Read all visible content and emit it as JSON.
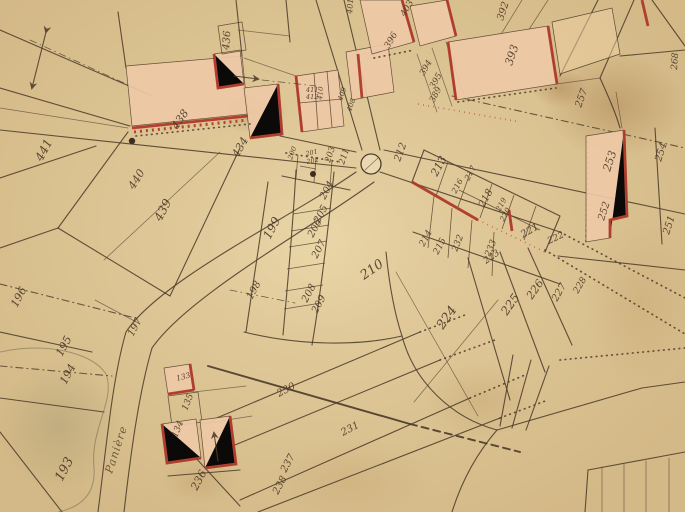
{
  "map": {
    "type": "historical-cadastral-map",
    "description": "Hand-drawn cadastral plan of a village crossroads with numbered parcels and red-edged buildings",
    "colors": {
      "paper": "#e6d0a2",
      "ink": "#4c3c2a",
      "building_fill": "#eec9a7",
      "building_edge": "#ae3a2b"
    },
    "road_label": {
      "text": "Panière",
      "x": 112,
      "y": 474,
      "rot": -72
    },
    "well": {
      "x": 371,
      "y": 164,
      "r": 10
    },
    "parcel_labels": [
      {
        "t": "441",
        "x": 42,
        "y": 162,
        "r": -62,
        "s": 12
      },
      {
        "t": "440",
        "x": 134,
        "y": 190,
        "r": -58,
        "s": 11
      },
      {
        "t": "439",
        "x": 161,
        "y": 222,
        "r": -62,
        "s": 12
      },
      {
        "t": "438",
        "x": 177,
        "y": 130,
        "r": -55,
        "s": 11
      },
      {
        "t": "434",
        "x": 238,
        "y": 158,
        "r": -60,
        "s": 11
      },
      {
        "t": "436",
        "x": 229,
        "y": 50,
        "r": -86,
        "s": 10
      },
      {
        "t": "411",
        "x": 306,
        "y": 92,
        "r": 0,
        "s": 6.5
      },
      {
        "t": "412",
        "x": 306,
        "y": 99,
        "r": 0,
        "s": 6.5
      },
      {
        "t": "410",
        "x": 322,
        "y": 100,
        "r": -85,
        "s": 7
      },
      {
        "t": "409",
        "x": 342,
        "y": 101,
        "r": -70,
        "s": 7
      },
      {
        "t": "408",
        "x": 351,
        "y": 112,
        "r": -70,
        "s": 7
      },
      {
        "t": "401",
        "x": 352,
        "y": 14,
        "r": -85,
        "s": 8
      },
      {
        "t": "403",
        "x": 405,
        "y": 17,
        "r": -60,
        "s": 9
      },
      {
        "t": "396",
        "x": 389,
        "y": 49,
        "r": -60,
        "s": 9
      },
      {
        "t": "394",
        "x": 424,
        "y": 76,
        "r": -60,
        "s": 8.5
      },
      {
        "t": "395",
        "x": 434,
        "y": 89,
        "r": -60,
        "s": 8.5
      },
      {
        "t": "389",
        "x": 434,
        "y": 103,
        "r": -62,
        "s": 8.5
      },
      {
        "t": "392",
        "x": 503,
        "y": 21,
        "r": -72,
        "s": 10
      },
      {
        "t": "393",
        "x": 512,
        "y": 66,
        "r": -72,
        "s": 11
      },
      {
        "t": "257",
        "x": 581,
        "y": 108,
        "r": -70,
        "s": 10
      },
      {
        "t": "268",
        "x": 677,
        "y": 70,
        "r": -86,
        "s": 9
      },
      {
        "t": "254",
        "x": 661,
        "y": 162,
        "r": -72,
        "s": 10
      },
      {
        "t": "253",
        "x": 610,
        "y": 172,
        "r": -72,
        "s": 11
      },
      {
        "t": "252",
        "x": 604,
        "y": 221,
        "r": -72,
        "s": 10
      },
      {
        "t": "251",
        "x": 669,
        "y": 235,
        "r": -72,
        "s": 10
      },
      {
        "t": "200",
        "x": 292,
        "y": 160,
        "r": -70,
        "s": 7
      },
      {
        "t": "201",
        "x": 306,
        "y": 156,
        "r": -12,
        "s": 6.5
      },
      {
        "t": "202",
        "x": 307,
        "y": 164,
        "r": -12,
        "s": 6.5
      },
      {
        "t": "203",
        "x": 330,
        "y": 163,
        "r": -72,
        "s": 8.5
      },
      {
        "t": "211",
        "x": 344,
        "y": 165,
        "r": -72,
        "s": 8.5
      },
      {
        "t": "212",
        "x": 400,
        "y": 162,
        "r": -70,
        "s": 10
      },
      {
        "t": "199",
        "x": 270,
        "y": 240,
        "r": -62,
        "s": 12
      },
      {
        "t": "198",
        "x": 252,
        "y": 300,
        "r": -62,
        "s": 10
      },
      {
        "t": "197",
        "x": 133,
        "y": 337,
        "r": -62,
        "s": 10
      },
      {
        "t": "196",
        "x": 17,
        "y": 308,
        "r": -62,
        "s": 11
      },
      {
        "t": "195",
        "x": 62,
        "y": 357,
        "r": -62,
        "s": 11
      },
      {
        "t": "194",
        "x": 66,
        "y": 385,
        "r": -62,
        "s": 11
      },
      {
        "t": "193",
        "x": 62,
        "y": 482,
        "r": -62,
        "s": 13
      },
      {
        "t": "204",
        "x": 325,
        "y": 200,
        "r": -62,
        "s": 10
      },
      {
        "t": "205",
        "x": 319,
        "y": 224,
        "r": -62,
        "s": 10
      },
      {
        "t": "206",
        "x": 313,
        "y": 238,
        "r": -62,
        "s": 10
      },
      {
        "t": "207",
        "x": 317,
        "y": 259,
        "r": -62,
        "s": 10
      },
      {
        "t": "208",
        "x": 307,
        "y": 303,
        "r": -62,
        "s": 10
      },
      {
        "t": "209",
        "x": 317,
        "y": 314,
        "r": -62,
        "s": 10
      },
      {
        "t": "210",
        "x": 364,
        "y": 280,
        "r": -35,
        "s": 13
      },
      {
        "t": "213",
        "x": 437,
        "y": 177,
        "r": -62,
        "s": 11
      },
      {
        "t": "216",
        "x": 456,
        "y": 194,
        "r": -62,
        "s": 8
      },
      {
        "t": "217",
        "x": 469,
        "y": 181,
        "r": -62,
        "s": 8
      },
      {
        "t": "218",
        "x": 484,
        "y": 208,
        "r": -62,
        "s": 10
      },
      {
        "t": "219",
        "x": 500,
        "y": 212,
        "r": -62,
        "s": 7.5
      },
      {
        "t": "220",
        "x": 504,
        "y": 222,
        "r": -62,
        "s": 7.5
      },
      {
        "t": "221",
        "x": 523,
        "y": 238,
        "r": -30,
        "s": 10
      },
      {
        "t": "222",
        "x": 549,
        "y": 244,
        "r": -25,
        "s": 9
      },
      {
        "t": "223",
        "x": 486,
        "y": 264,
        "r": -35,
        "s": 9
      },
      {
        "t": "214",
        "x": 424,
        "y": 247,
        "r": -62,
        "s": 9
      },
      {
        "t": "215",
        "x": 438,
        "y": 255,
        "r": -62,
        "s": 9
      },
      {
        "t": "232",
        "x": 457,
        "y": 252,
        "r": -68,
        "s": 9
      },
      {
        "t": "233",
        "x": 490,
        "y": 257,
        "r": -68,
        "s": 9
      },
      {
        "t": "224",
        "x": 443,
        "y": 330,
        "r": -55,
        "s": 13
      },
      {
        "t": "225",
        "x": 507,
        "y": 316,
        "r": -55,
        "s": 12
      },
      {
        "t": "226",
        "x": 532,
        "y": 300,
        "r": -55,
        "s": 11
      },
      {
        "t": "227",
        "x": 557,
        "y": 302,
        "r": -60,
        "s": 10
      },
      {
        "t": "228",
        "x": 578,
        "y": 294,
        "r": -60,
        "s": 9
      },
      {
        "t": "230",
        "x": 279,
        "y": 397,
        "r": -28,
        "s": 10
      },
      {
        "t": "231",
        "x": 343,
        "y": 436,
        "r": -28,
        "s": 10
      },
      {
        "t": "236",
        "x": 197,
        "y": 491,
        "r": -62,
        "s": 11
      },
      {
        "t": "237",
        "x": 286,
        "y": 473,
        "r": -62,
        "s": 10
      },
      {
        "t": "238",
        "x": 278,
        "y": 495,
        "r": -62,
        "s": 10
      },
      {
        "t": "133",
        "x": 177,
        "y": 381,
        "r": -15,
        "s": 7.5
      },
      {
        "t": "135",
        "x": 187,
        "y": 411,
        "r": -68,
        "s": 9
      },
      {
        "t": "134",
        "x": 177,
        "y": 438,
        "r": -68,
        "s": 9
      }
    ]
  }
}
